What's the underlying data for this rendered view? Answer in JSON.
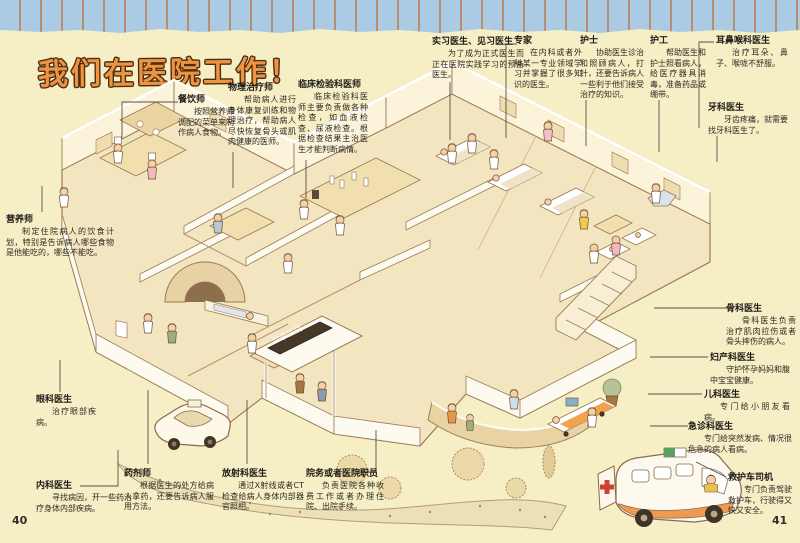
{
  "title": "我们在医院工作！",
  "hospital_sign": "四季医院",
  "page": {
    "left_number": "40",
    "right_number": "41"
  },
  "colors": {
    "page_background": "#f6eec5",
    "title_orange": "#ee9340",
    "title_outline": "#4a2d12",
    "band_blue": "#aacbe3",
    "band_stripe": "#b78e70",
    "sign_background": "#463829",
    "ambulance_trim_orange": "#ef9a50",
    "red_cross": "#d04030"
  },
  "labels": [
    {
      "id": "catering-cook",
      "title": "餐饮师",
      "body": "按照营养师调配的菜单来制作病人食物。"
    },
    {
      "id": "physical-therapist",
      "title": "物理治疗师",
      "body": "帮助病人进行身体康复训练和物理治疗，帮助病人尽快恢复骨头或肌肉健康的医师。"
    },
    {
      "id": "clinical-lab-doctor",
      "title": "临床检验科医师",
      "body": "临床检验科医师主要负责做各种检查，如血液检查、尿液检查。根据检查结果主治医生才能判断病情。"
    },
    {
      "id": "intern-doctor",
      "title": "实习医生、见习医生",
      "body": "为了成为正式医生而正在医院实践学习的预备医生。"
    },
    {
      "id": "specialist",
      "title": "专家",
      "body": "在内科或者外科某一专业领域学习并掌握了很多知识的医生。"
    },
    {
      "id": "nurse",
      "title": "护士",
      "body": "协助医生诊治和照顾病人，打针，还要告诉病人一些利于他们接受治疗的知识。"
    },
    {
      "id": "orderly",
      "title": "护工",
      "body": "帮助医生和护士照看病人，给医疗器具消毒，准备药品或绷带。"
    },
    {
      "id": "ent-doctor",
      "title": "耳鼻喉科医生",
      "body": "治疗耳朵、鼻子、喉咙不舒服。"
    },
    {
      "id": "dentist",
      "title": "牙科医生",
      "body": "牙齿疼痛，就需要找牙科医生了。"
    },
    {
      "id": "orthopedist",
      "title": "骨科医生",
      "body": "骨科医生负责治疗肌肉拉伤或者骨头摔伤的病人。"
    },
    {
      "id": "obstetrician",
      "title": "妇产科医生",
      "body": "守护怀孕妈妈和腹中宝宝健康。"
    },
    {
      "id": "pediatrician",
      "title": "儿科医生",
      "body": "专门给小朋友看病。"
    },
    {
      "id": "emergency-doctor",
      "title": "急诊科医生",
      "body": "专门给突然发病、情况很危急的病人看病。"
    },
    {
      "id": "ambulance-driver",
      "title": "救护车司机",
      "body": "专门负责驾驶救护车，行驶得又快又安全。"
    },
    {
      "id": "nutritionist",
      "title": "营养师",
      "body": "制定住院病人的饮食计划，特别是告诉病人哪些食物是他能吃的，哪些不能吃。"
    },
    {
      "id": "ophthalmologist",
      "title": "眼科医生",
      "body": "治疗眼部疾病。"
    },
    {
      "id": "internist",
      "title": "内科医生",
      "body": "寻找病因，开一些药治疗身体内部疾病。"
    },
    {
      "id": "pharmacist",
      "title": "药剂师",
      "body": "根据医生的处方给病人拿药，还要告诉病人服用方法。"
    },
    {
      "id": "radiologist",
      "title": "放射科医生",
      "body": "通过X射线或者CT检查给病人身体内部器官照相。"
    },
    {
      "id": "hospital-staff",
      "title": "院务或者医院职员",
      "body": "负责医院各种收费工作或者办理住院、出院手续。"
    }
  ]
}
